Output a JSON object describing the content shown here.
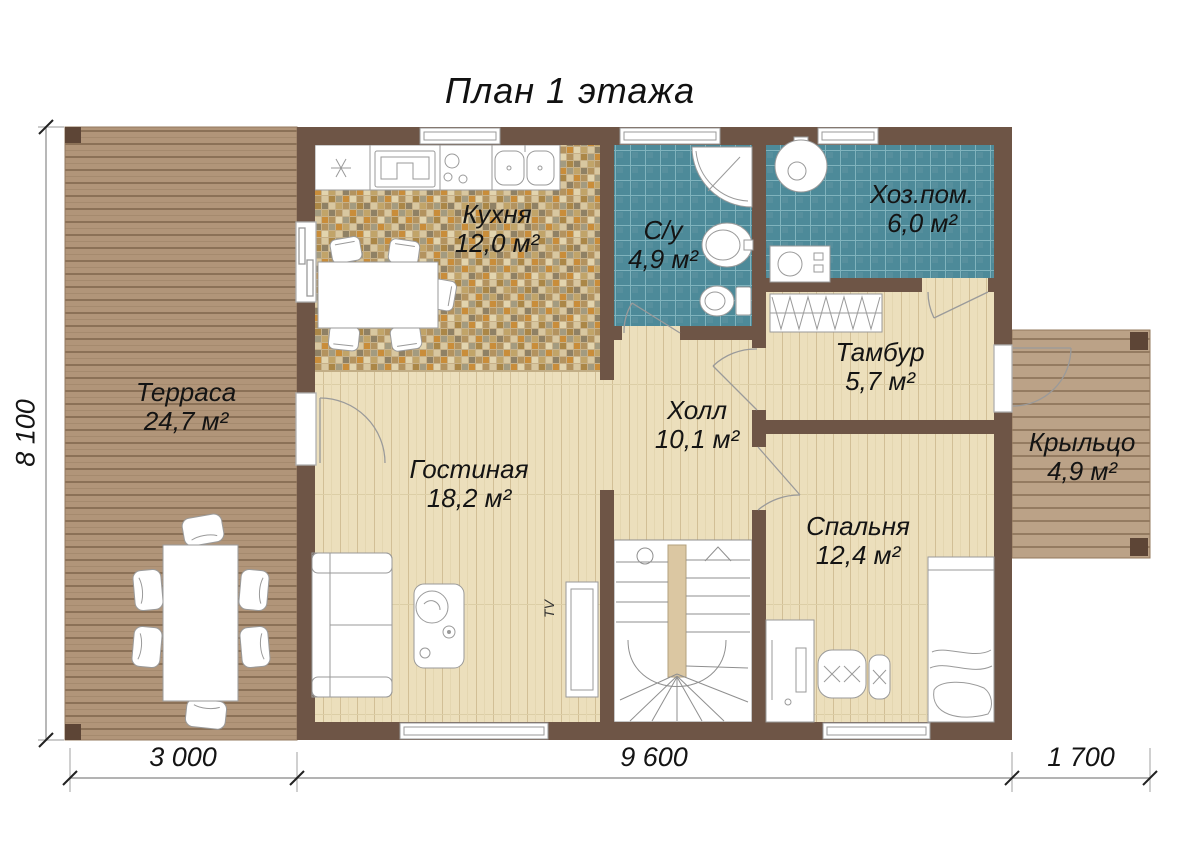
{
  "title": "План 1 этажа",
  "rooms": {
    "terrace": {
      "name": "Терраса",
      "area": "24,7 м²"
    },
    "kitchen": {
      "name": "Кухня",
      "area": "12,0 м²"
    },
    "bathroom": {
      "name": "С/у",
      "area": "4,9 м²"
    },
    "utility": {
      "name": "Хоз.пом.",
      "area": "6,0 м²"
    },
    "vestibule": {
      "name": "Тамбур",
      "area": "5,7 м²"
    },
    "hall": {
      "name": "Холл",
      "area": "10,1 м²"
    },
    "living": {
      "name": "Гостиная",
      "area": "18,2 м²"
    },
    "bedroom": {
      "name": "Спальня",
      "area": "12,4 м²"
    },
    "porch": {
      "name": "Крыльцо",
      "area": "4,9 м²"
    }
  },
  "dimensions": {
    "height_left": "8 100",
    "width_terrace": "3 000",
    "width_house": "9 600",
    "width_porch": "1 700"
  },
  "labels": {
    "tv": "TV"
  },
  "colors": {
    "wall": "#6e5546",
    "wood_floor": "#ecdfbc",
    "deck": "#b19579",
    "bath_tile": "#4d8a99",
    "mosaic_base": "#c7b189"
  }
}
